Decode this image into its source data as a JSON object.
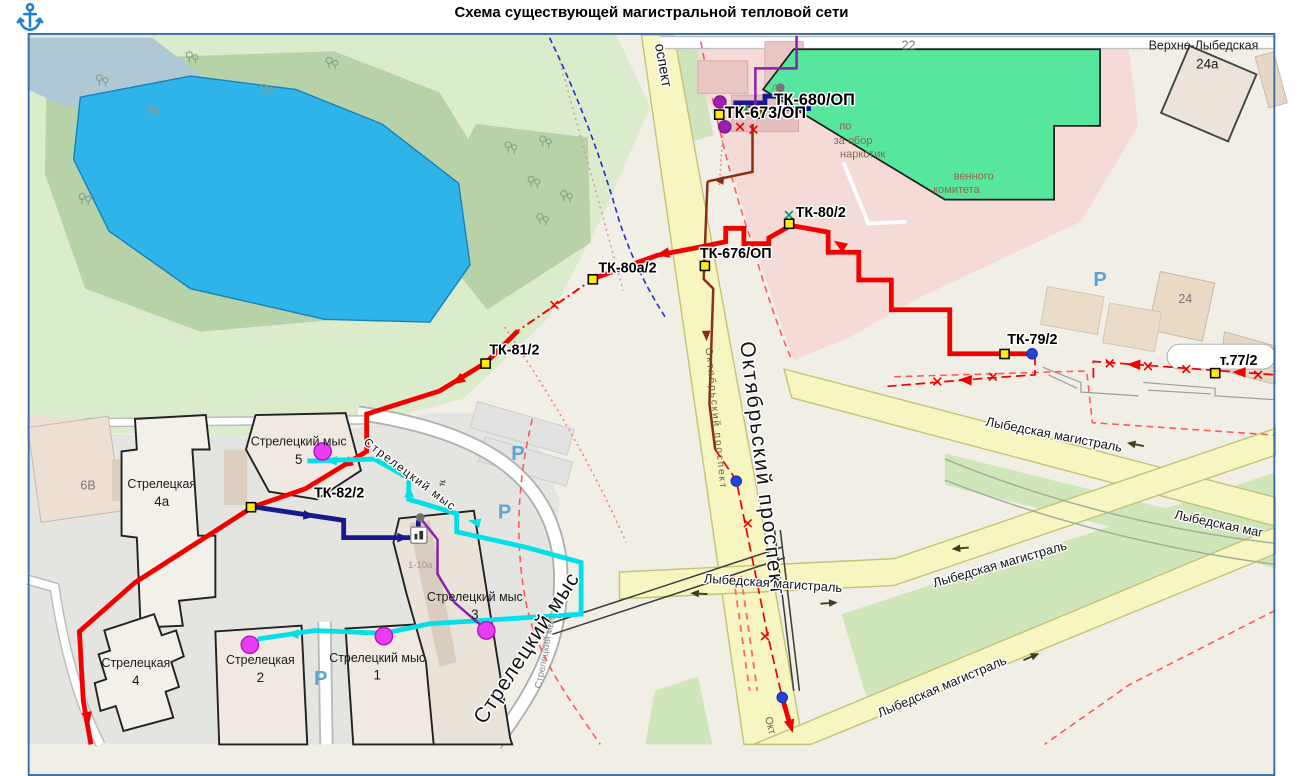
{
  "header": {
    "title": "Схема существующей магистральной тепловой сети",
    "anchor_icon": "anchor"
  },
  "map": {
    "nodes": [
      {
        "id": "tk-680-op",
        "label": "ТК-680/ОП"
      },
      {
        "id": "tk-673-op",
        "label": "ТК-673/ОП"
      },
      {
        "id": "tk-80-2",
        "label": "ТК-80/2"
      },
      {
        "id": "tk-676-op",
        "label": "ТК-676/ОП"
      },
      {
        "id": "tk-80a-2",
        "label": "ТК-80а/2"
      },
      {
        "id": "tk-81-2",
        "label": "ТК-81/2"
      },
      {
        "id": "tk-82-2",
        "label": "ТК-82/2"
      },
      {
        "id": "tk-79-2",
        "label": "ТК-79/2"
      },
      {
        "id": "t-77-2",
        "label": "т.77/2"
      }
    ],
    "streets": {
      "oktyabrsky": "Октябрьский проспект",
      "oktyabrsky_fragment": "оспект",
      "oktyabrsky_fragment_bottom": "Окт",
      "lybedskaya": "Лыбедская магистраль",
      "lybedskaya_clipped": "Лыбедская маг",
      "streletsky": "Стрелецкий мыс"
    },
    "buildings": {
      "streletskaya_4a": {
        "name": "Стрелецкая",
        "num": "4а"
      },
      "streletskaya_4": {
        "name": "Стрелецкая",
        "num": "4"
      },
      "streletskaya_2": {
        "name": "Стрелецкая",
        "num": "2"
      },
      "streletsky_mys_1": {
        "name": "Стрелецкий мыс",
        "num": "1"
      },
      "streletsky_mys_3": {
        "name": "Стрелецкий мыс",
        "num": "3"
      },
      "streletsky_mys_5": {
        "name": "Стрелецкий мыс",
        "num": "5"
      },
      "verhne_lybedskaya": {
        "name": "Верхне-Лыбедская",
        "num": "24а"
      },
      "b22": "22",
      "b24": "24",
      "b6v": "6В",
      "b110a": "1-10а"
    },
    "poi_fragments": {
      "line1": "по",
      "line2": "за обор",
      "line3": "наркотик",
      "committee1": "венного",
      "committee2": "комитета",
      "do": "до"
    },
    "symbols": {
      "parking": "Р",
      "not_equal": "≠"
    },
    "colors": {
      "supply_main": "#f20000",
      "return_line": "#8b2f10",
      "branch_navy": "#18188f",
      "branch_cyan": "#00e0e6",
      "branch_purple": "#8a1fae",
      "consumer": "#ea3cf0",
      "node_fill": "#ffec00",
      "point_blue": "#2244dd",
      "water": "#2fb4e9",
      "selected_building": "#57e69e"
    }
  }
}
